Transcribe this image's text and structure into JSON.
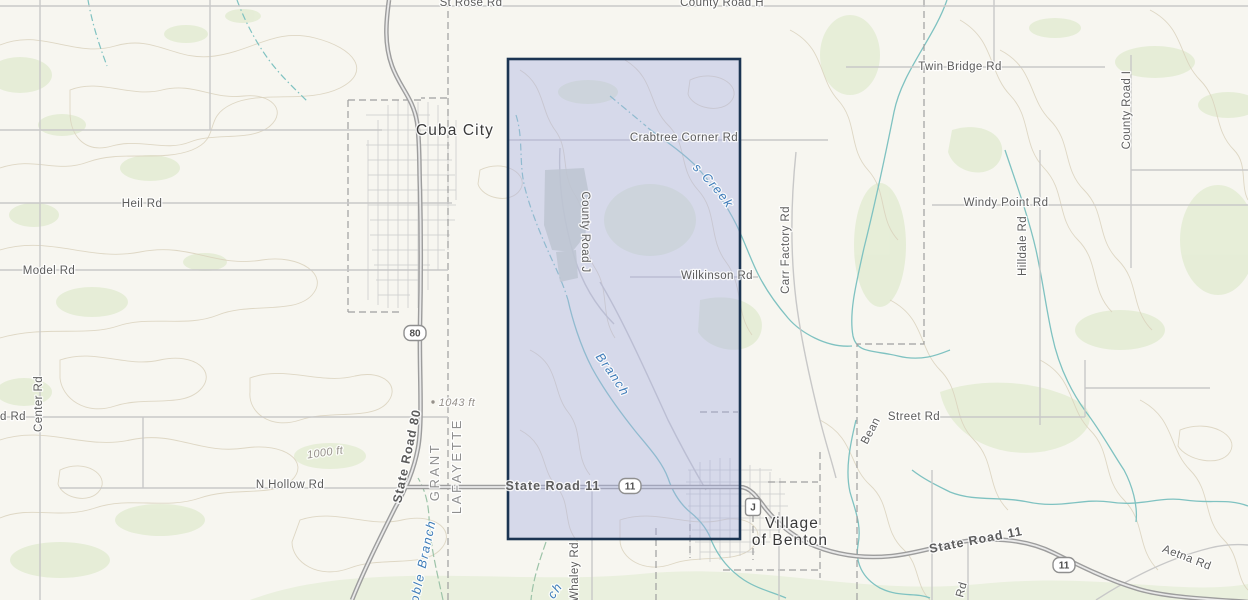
{
  "map": {
    "kind": "topographic-basemap-with-selection",
    "selection": {
      "fill": "#aab1e2",
      "fill_opacity": "0.42",
      "border": "#1b3452",
      "border_width": "2.6"
    },
    "palette": {
      "background": "#f7f6f0",
      "vegetation": "#e2ecd2",
      "contour": "#d9d1bc",
      "stream": "#7fc2c1",
      "stream_green": "#9cc3a8",
      "road_minor": "#c8c8c8",
      "highway_casing": "#9d9d9d",
      "highway_core": "#e9e9e9",
      "urban_grid": "#cccccc",
      "boundary": "#9f9f9f",
      "forest_patch": "#cdd5c6",
      "road_label": "#5c5c5c",
      "stream_label": "#3e7cb9",
      "city_label": "#3a3a3a",
      "county_label": "#8f8f8f",
      "elevation_label": "#95908a",
      "shield_border": "#8f8f8f",
      "shield_text": "#4f4f4f"
    },
    "labels": {
      "roads": [
        {
          "text": "St Rose Rd"
        },
        {
          "text": "County Road H"
        },
        {
          "text": "Twin Bridge Rd"
        },
        {
          "text": "County Road I"
        },
        {
          "text": "Crabtree Corner Rd"
        },
        {
          "text": "Heil Rd"
        },
        {
          "text": "Windy Point Rd"
        },
        {
          "text": "Hilldale Rd"
        },
        {
          "text": "Model Rd"
        },
        {
          "text": "County Road J"
        },
        {
          "text": "Wilkinson Rd"
        },
        {
          "text": "Carr Factory Rd"
        },
        {
          "text": "Center Rd"
        },
        {
          "text": "d Rd"
        },
        {
          "text": "State Road 80"
        },
        {
          "text": "N Hollow Rd"
        },
        {
          "text": "State Road 11"
        },
        {
          "text": "Bean"
        },
        {
          "text": "Street Rd"
        },
        {
          "text": "State Road 11"
        },
        {
          "text": "Aetna Rd"
        },
        {
          "text": "Whaley Rd"
        },
        {
          "text": "Rd"
        }
      ],
      "streams": [
        {
          "text": "Blacks Creek"
        },
        {
          "text": "Coon Branch"
        },
        {
          "text": "oble Branch"
        },
        {
          "text": "ch"
        }
      ],
      "cities": {
        "cuba_city": "Cuba City",
        "benton_line1": "Village",
        "benton_line2": "of Benton"
      },
      "counties": {
        "west": "GRANT",
        "east": "LAFAYETTE"
      },
      "elevations": {
        "spot": "1043 ft",
        "contour": "1000 ft"
      },
      "shields": {
        "sr80": "80",
        "sr11_a": "11",
        "sr11_b": "11",
        "county_j": "J"
      }
    }
  }
}
